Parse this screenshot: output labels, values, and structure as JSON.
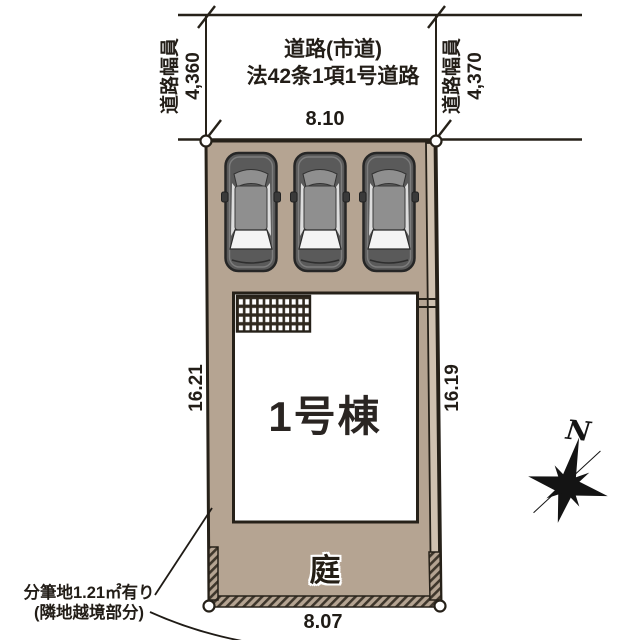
{
  "drawing": {
    "road": {
      "name_line1": "道路(市道)",
      "name_line2": "法42条1項1号道路",
      "left_width_label": "道路幅員",
      "left_width_value": "4,360",
      "right_width_label": "道路幅員",
      "right_width_value": "4,370"
    },
    "dimensions": {
      "top": "8.10",
      "bottom": "8.07",
      "left": "16.21",
      "right": "16.19"
    },
    "building": {
      "label": "1号棟"
    },
    "garden": {
      "label": "庭"
    },
    "note": {
      "line1": "分筆地1.21㎡有り",
      "line2": "(隣地越境部分)"
    },
    "compass": {
      "north_label": "N"
    },
    "cars": {
      "count": 3
    },
    "colors": {
      "land": "#b5a492",
      "land_strip": "#cfc1b0",
      "outline": "#262119",
      "hatch_dark": "#3f372c",
      "building_fill": "#ffffff",
      "car_body": "#5a5a5a",
      "car_roof": "#8f8f8f"
    }
  }
}
